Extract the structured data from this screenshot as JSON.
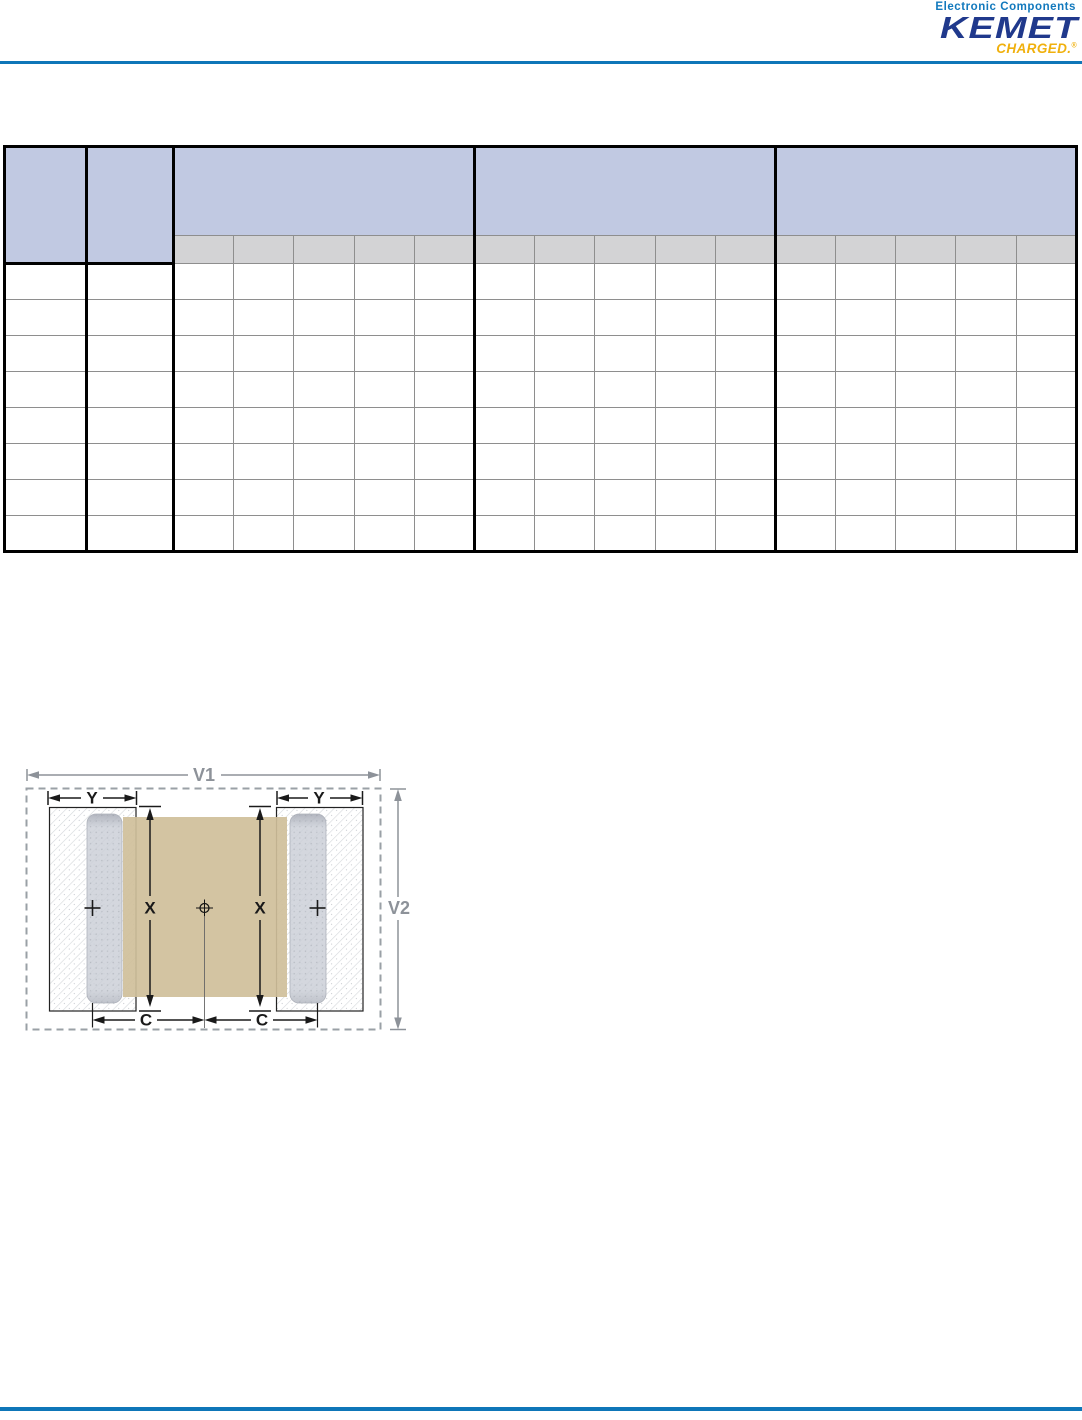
{
  "header": {
    "tagline": "Electronic Components",
    "brand": "KEMET",
    "sub_brand": "CHARGED.",
    "registered_mark": "®"
  },
  "colors": {
    "rule_blue": "#0e76b8",
    "brand_navy": "#20398c",
    "brand_gold": "#f0b00d",
    "tagline_blue": "#1279bd",
    "table_header_blue": "#c1c9e2",
    "table_subheader_gray": "#d3d3d5",
    "grid_gray": "#8e8e8e",
    "chip_body_tan": "#cfbf9a",
    "termination_gray": "#ccd0d8",
    "dimension_gray": "#8d9299"
  },
  "table": {
    "header": {
      "col_a_label": "",
      "col_b_label": "",
      "group_labels": [
        "",
        "",
        ""
      ],
      "sub_labels": [
        [
          "",
          "",
          "",
          "",
          ""
        ],
        [
          "",
          "",
          "",
          "",
          ""
        ],
        [
          "",
          "",
          "",
          "",
          ""
        ]
      ]
    },
    "rows": [
      [
        "",
        "",
        "",
        "",
        "",
        "",
        "",
        "",
        "",
        "",
        "",
        "",
        "",
        "",
        "",
        "",
        ""
      ],
      [
        "",
        "",
        "",
        "",
        "",
        "",
        "",
        "",
        "",
        "",
        "",
        "",
        "",
        "",
        "",
        "",
        ""
      ],
      [
        "",
        "",
        "",
        "",
        "",
        "",
        "",
        "",
        "",
        "",
        "",
        "",
        "",
        "",
        "",
        "",
        ""
      ],
      [
        "",
        "",
        "",
        "",
        "",
        "",
        "",
        "",
        "",
        "",
        "",
        "",
        "",
        "",
        "",
        "",
        ""
      ],
      [
        "",
        "",
        "",
        "",
        "",
        "",
        "",
        "",
        "",
        "",
        "",
        "",
        "",
        "",
        "",
        "",
        ""
      ],
      [
        "",
        "",
        "",
        "",
        "",
        "",
        "",
        "",
        "",
        "",
        "",
        "",
        "",
        "",
        "",
        "",
        ""
      ],
      [
        "",
        "",
        "",
        "",
        "",
        "",
        "",
        "",
        "",
        "",
        "",
        "",
        "",
        "",
        "",
        "",
        ""
      ],
      [
        "",
        "",
        "",
        "",
        "",
        "",
        "",
        "",
        "",
        "",
        "",
        "",
        "",
        "",
        "",
        "",
        ""
      ]
    ]
  },
  "diagram": {
    "labels": {
      "v1": "V1",
      "v2": "V2",
      "x": "X",
      "y": "Y",
      "c": "C"
    }
  }
}
